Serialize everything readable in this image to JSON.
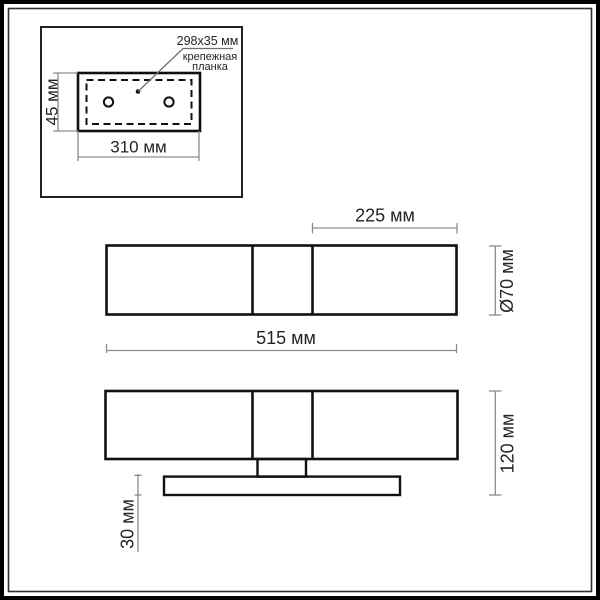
{
  "colors": {
    "background": "#ffffff",
    "main_line": "#111111",
    "dimension_line": "#8c8c8c",
    "text": "#242424",
    "frame": "#000000"
  },
  "mounting_plate_inset": {
    "callout_size": "298x35 мм",
    "callout_name_line1": "крепежная",
    "callout_name_line2": "планка",
    "height_dim": "45 мм",
    "width_dim": "310 мм"
  },
  "top_view": {
    "shade_length_dim": "225 мм",
    "diameter_dim": "Ø70 мм",
    "overall_length_dim": "515 мм"
  },
  "front_view": {
    "overall_height_dim": "120 мм",
    "base_thickness_dim": "30 мм"
  }
}
